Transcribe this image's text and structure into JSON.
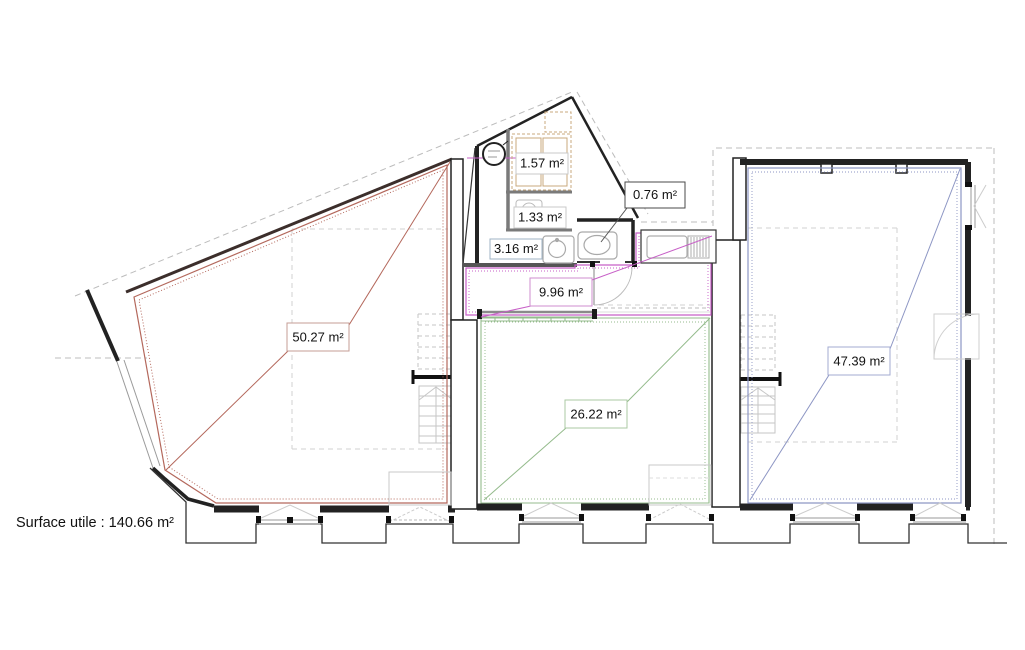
{
  "plan": {
    "footer": {
      "surface_text": "Surface utile : 140.66 m²"
    },
    "labels": {
      "room_5027": "50.27 m²",
      "room_157": "1.57 m²",
      "room_133": "1.33 m²",
      "room_316": "3.16 m²",
      "room_076": "0.76 m²",
      "room_996": "9.96 m²",
      "room_2622": "26.22 m²",
      "room_4739": "47.39 m²"
    },
    "colors": {
      "room_5027_outline": "#b4685c",
      "room_996_outline": "#c75fc7",
      "room_2622_outline": "#94bb8c",
      "room_4739_outline": "#8d96c4",
      "walls": "#222222",
      "boundary_dashed": "#bcbcbc",
      "fixtures_gray": "#b9b9b9",
      "furniture_tan": "#c9a87c"
    },
    "icons": [
      "water-heater-icon",
      "toilet-icon",
      "sink-icon",
      "kitchen-sink-icon",
      "stair-ibeam-icon"
    ]
  }
}
